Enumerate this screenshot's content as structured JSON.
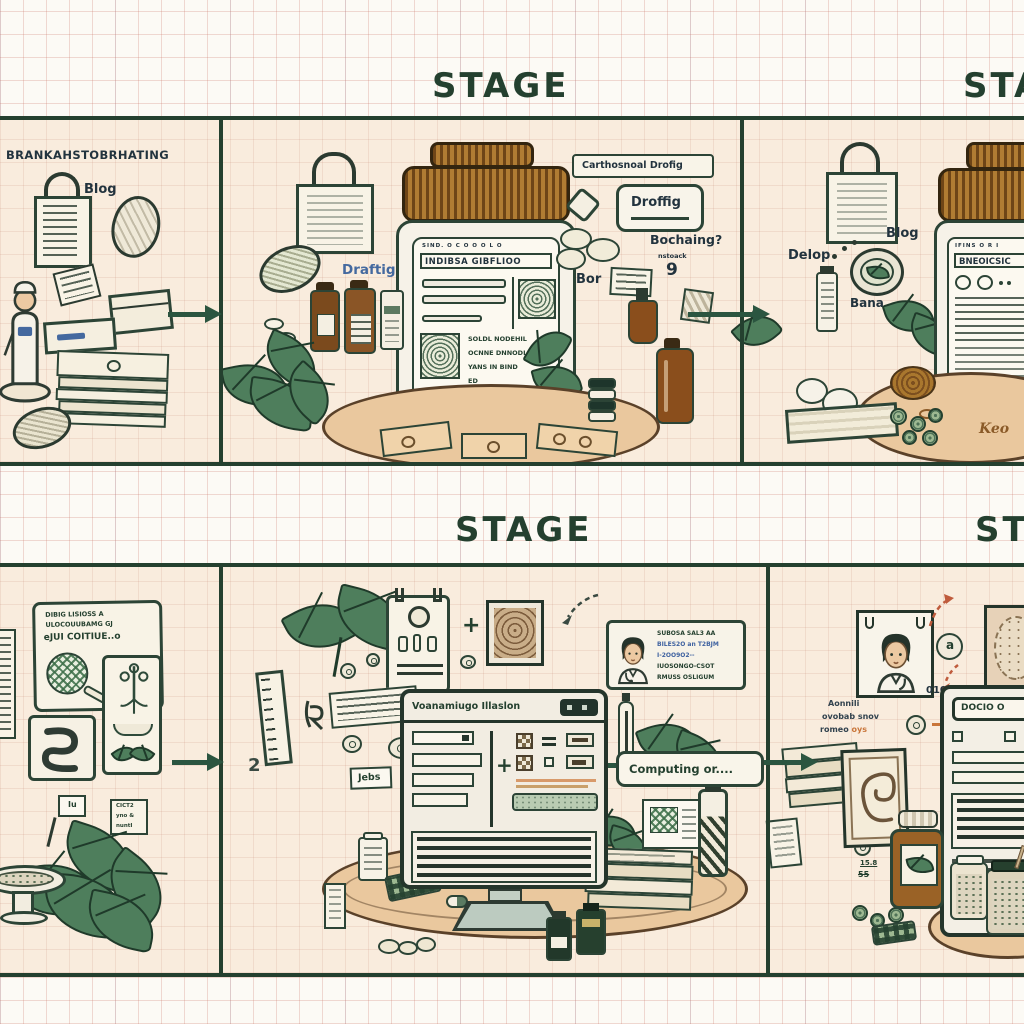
{
  "headers": {
    "stage_top": "STAGE",
    "sta_top_right": "STA",
    "stage_bottom": "STAGE",
    "sta_bottom_right": "STA"
  },
  "misc": {
    "plus": "+"
  },
  "top_left": {
    "title": "BRANKAHSTOBRHATING",
    "blog": "Blog"
  },
  "top_mid": {
    "draft_note": "Draftig",
    "label_box": "Carthosnoal Drofig",
    "draft_box": "Droffig",
    "bochaing": "Bochaing?",
    "nstoack": "nstoack",
    "nine": "9",
    "bor": "Bor",
    "jar_top_row": "SIND. O C O O O L O",
    "jar_title": "INDIBSA GIBFLIOO",
    "jar_l1": "SOLDL  NODEHIL",
    "jar_l2": "OCNNE  DNNODLE",
    "jar_l3": "YANS IN  BIND",
    "jar_l4": "ED"
  },
  "top_right": {
    "blog": "Blog",
    "delop": "Delop",
    "bana": "Bana",
    "jar_top_row": "IFINS O R I",
    "jar_title": "BNEOICSIC",
    "table_script": "Keo"
  },
  "bottom_left": {
    "card_l1": "DIBIG LISIOSS A",
    "card_l2": "ULOCOUUBAMG GJ",
    "card_l3": "eJUI COITIUE..o",
    "tag": "Iu",
    "note_l1": "CICT2",
    "note_l2": "yno &",
    "note_l3": "nuntI"
  },
  "bottom_mid": {
    "browser_title": "Voanamiugo Illaslon",
    "two": "2",
    "jebs": "Jebs",
    "doc_l1": "SUBOSA SAL3 AA",
    "doc_l2": "BILES2O an T2BJM",
    "doc_l3": "I-2OO9O2--",
    "doc_l4": "IUOSONGO-CSOT",
    "doc_l5": "RMUSS OSLIGUM",
    "computing": "Computing or...."
  },
  "bottom_right": {
    "code": "01017 ?",
    "coin": "a",
    "note_l1": "Aonnili",
    "note_l2": "ovobab snov",
    "note_l3a": "romeo ",
    "note_l3b": "oys",
    "browser_title": "DOCIO O",
    "small_1": "IU IGJI",
    "small_2": "IU Rqio",
    "small_3": "15.8",
    "small_4": "55"
  }
}
